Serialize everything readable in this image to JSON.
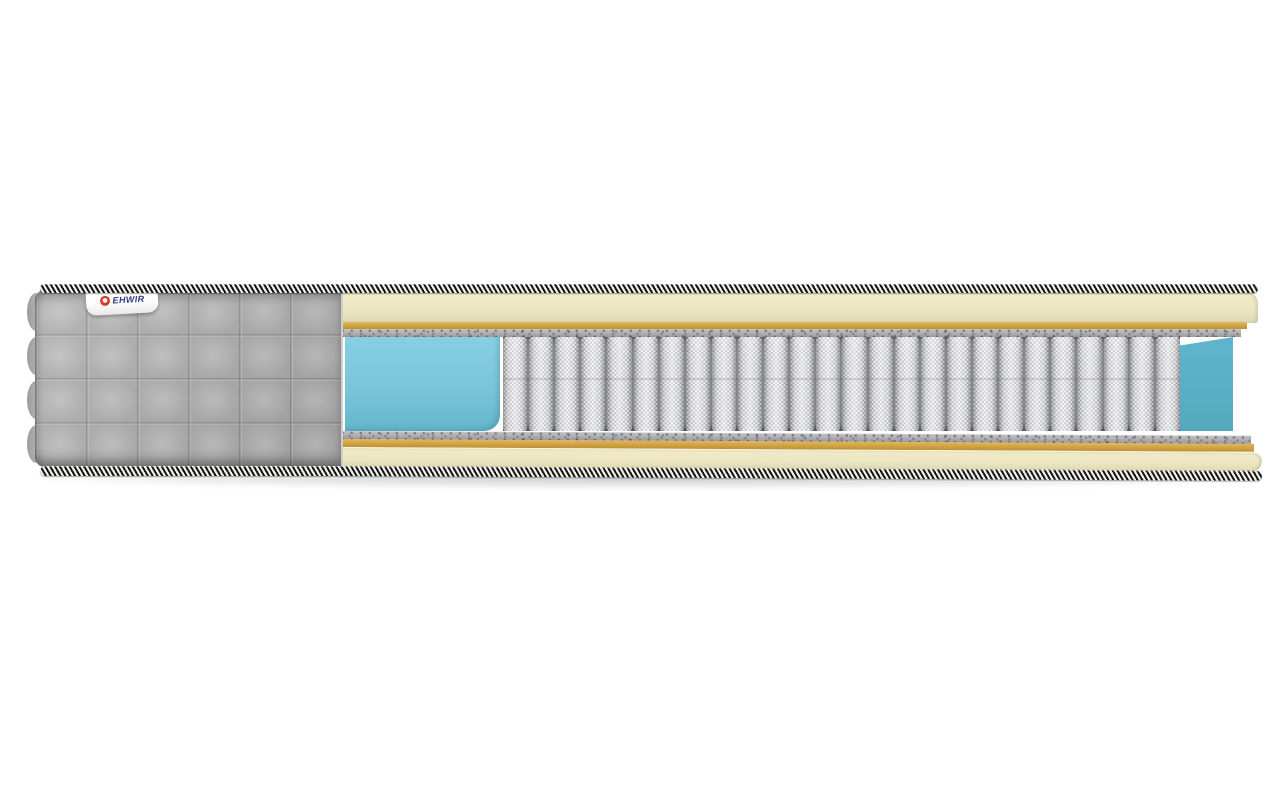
{
  "scene": {
    "description": "3D product render of a mattress shown in cross-section cutaway on white background",
    "background_color": "#ffffff"
  },
  "brand_tag": {
    "text": "EHWIR",
    "text_color": "#2c3a85",
    "logo_icon": "red-ring-icon",
    "logo_color": "#d93a2e",
    "background": "#ffffff"
  },
  "layers": {
    "quilted_cover": {
      "label": "gray quilted fabric cover",
      "color": "#aeaeae",
      "rows": 4,
      "cols": 6
    },
    "piping": {
      "label": "striped edge piping band",
      "dark": "#161616",
      "light": "#efeee6"
    },
    "comfort_foam_top": {
      "label": "top comfort foam slab",
      "color": "#ece6c2"
    },
    "adhesive_line_top": {
      "label": "tan adhesive line",
      "color": "#cda041"
    },
    "felt_pad_top": {
      "label": "speckled felt pad (top)",
      "color": "#b1b0b2"
    },
    "soft_foam_block": {
      "label": "blue foam block at cut",
      "color": "#7ac5da"
    },
    "pocket_springs": {
      "label": "independent pocket spring unit",
      "count": 26,
      "color": "#ececec",
      "gap_color": "#84868c"
    },
    "back_foam_panel": {
      "label": "blue rear foam wall",
      "color": "#5fb6cc"
    },
    "felt_pad_bottom": {
      "label": "speckled felt pad (bottom)",
      "color": "#b1b0b2"
    },
    "adhesive_line_bottom": {
      "label": "tan adhesive line",
      "color": "#cda041"
    },
    "comfort_foam_bottom": {
      "label": "bottom comfort foam slab",
      "color": "#ece6c2"
    }
  }
}
